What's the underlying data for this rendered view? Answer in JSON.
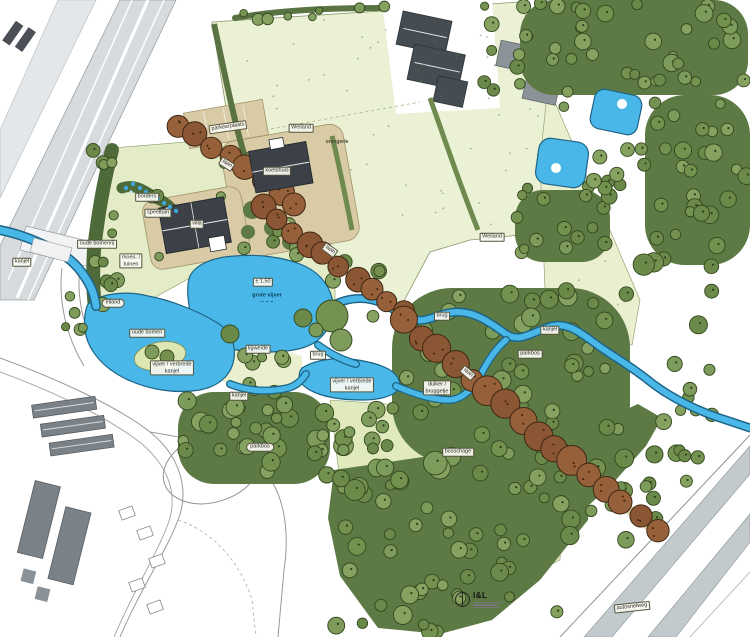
{
  "title": "landschapsplan park met villa en kanjel",
  "colors": {
    "water": "#49b8e8",
    "water_outline": "#1d6486",
    "meadow": "#ebf1d4",
    "lawn": "#e3ecc6",
    "field": "#e0eabd",
    "tree": "#7d9b5a",
    "tree_dark": "#5d7a45",
    "lane_brown": "#8a5634",
    "path_beige": "#d9cba6",
    "building_dark": "#3b4147",
    "building_gray": "#7b8287",
    "road_gray": "#c3cacd"
  },
  "logo": {
    "text": "I&L"
  },
  "labels": [
    {
      "id": "parkeerplaats",
      "text": "parkeerplaats",
      "x": 228,
      "y": 127,
      "style": "box",
      "rot": -8
    },
    {
      "id": "weiland-1",
      "text": "Weiland",
      "x": 301,
      "y": 128,
      "style": "box",
      "rot": 0
    },
    {
      "id": "orangerie",
      "text": "orangerie",
      "x": 337,
      "y": 142,
      "style": "plain small",
      "rot": 0
    },
    {
      "id": "laan-1",
      "text": "laan",
      "x": 227,
      "y": 164,
      "style": "box",
      "rot": 32
    },
    {
      "id": "koetshuis",
      "text": "koetshuis",
      "x": 277,
      "y": 171,
      "style": "box",
      "rot": 0
    },
    {
      "id": "villa",
      "text": "villa",
      "x": 197,
      "y": 224,
      "style": "box",
      "rot": 0
    },
    {
      "id": "borders",
      "text": "borders",
      "x": 147,
      "y": 197,
      "style": "box",
      "rot": 0
    },
    {
      "id": "speeltuin",
      "text": "speeltuin",
      "x": 158,
      "y": 213,
      "style": "box",
      "rot": 0
    },
    {
      "id": "oude-bomenrij",
      "text": "oude bomenrij",
      "x": 97,
      "y": 244,
      "style": "box",
      "rot": 0
    },
    {
      "id": "moestuinen",
      "text": "moes- /\ntuinen",
      "x": 131,
      "y": 261,
      "style": "box",
      "rot": 0
    },
    {
      "id": "kanjel-1",
      "text": "kanjel",
      "x": 22,
      "y": 262,
      "style": "box",
      "rot": 0
    },
    {
      "id": "eiland",
      "text": "eiland",
      "x": 113,
      "y": 303,
      "style": "oval",
      "rot": 0
    },
    {
      "id": "diepte",
      "text": "± 1.50",
      "x": 263,
      "y": 282,
      "style": "box",
      "rot": 0
    },
    {
      "id": "grote-vijver",
      "text": "grote vijver\n~ ~ ~",
      "x": 267,
      "y": 299,
      "style": "plain",
      "rot": 0
    },
    {
      "id": "oude-bomen",
      "text": "oude bomen",
      "x": 147,
      "y": 333,
      "style": "box",
      "rot": 0
    },
    {
      "id": "vijver-verbrede-1",
      "text": "vijver / verbrede\nkanjel",
      "x": 172,
      "y": 368,
      "style": "box",
      "rot": 0
    },
    {
      "id": "ligweide",
      "text": "ligweide",
      "x": 258,
      "y": 349,
      "style": "box",
      "rot": 0
    },
    {
      "id": "kanjel-2",
      "text": "kanjel",
      "x": 239,
      "y": 396,
      "style": "box",
      "rot": 0
    },
    {
      "id": "vijver-verbrede-2",
      "text": "vijver / verbrede\nkanjel",
      "x": 352,
      "y": 385,
      "style": "box",
      "rot": 0
    },
    {
      "id": "laan-2",
      "text": "laan",
      "x": 330,
      "y": 250,
      "style": "box",
      "rot": 36
    },
    {
      "id": "brug-1",
      "text": "brug",
      "x": 318,
      "y": 355,
      "style": "box",
      "rot": 0
    },
    {
      "id": "brug-2",
      "text": "brug",
      "x": 442,
      "y": 316,
      "style": "box",
      "rot": 0
    },
    {
      "id": "kanjel-3",
      "text": "kanjel",
      "x": 550,
      "y": 330,
      "style": "box",
      "rot": 0
    },
    {
      "id": "parkbos-1",
      "text": "parkbos",
      "x": 530,
      "y": 354,
      "style": "box",
      "rot": 0
    },
    {
      "id": "laan-3",
      "text": "laan",
      "x": 468,
      "y": 373,
      "style": "box",
      "rot": 40
    },
    {
      "id": "duiker-bruggetje",
      "text": "duiker /\nbruggetje",
      "x": 437,
      "y": 388,
      "style": "box",
      "rot": 0
    },
    {
      "id": "bosschage",
      "text": "bosschage",
      "x": 458,
      "y": 452,
      "style": "box",
      "rot": 0
    },
    {
      "id": "parkbos-2",
      "text": "parkbos",
      "x": 260,
      "y": 447,
      "style": "oval",
      "rot": 0
    },
    {
      "id": "weiland-2",
      "text": "Weiland",
      "x": 492,
      "y": 237,
      "style": "box",
      "rot": 0
    },
    {
      "id": "autosnelweg",
      "text": "autosnelweg",
      "x": 632,
      "y": 607,
      "style": "box",
      "rot": -6
    }
  ]
}
